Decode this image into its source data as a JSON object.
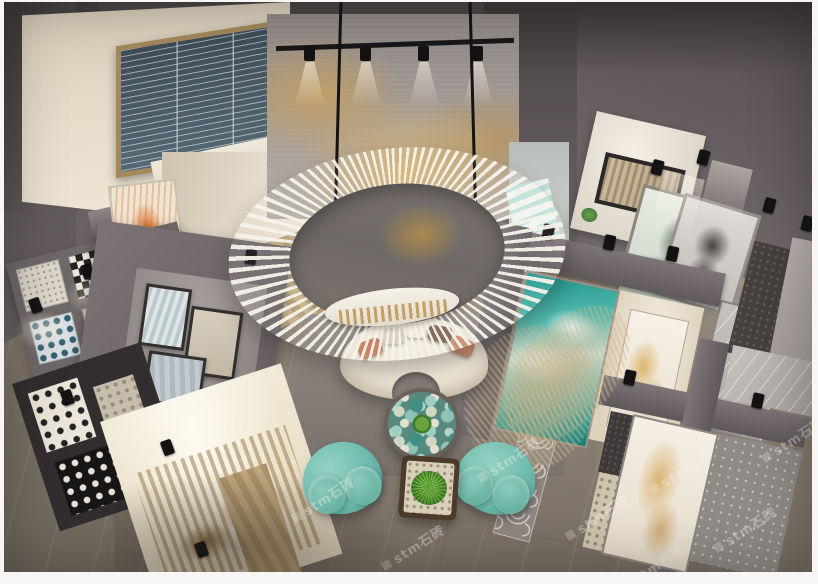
{
  "meta": {
    "title": "Tile and stone showroom interior - aerial 3D render",
    "description": "Bird's-eye view of a two-storey tile showroom: central white ring swing sculpture hanging over a curved cream sofa, pebble-top coffee table, two teal armchairs with a planted side table, gold-leaf feature mural wall, mezzanine window with blinds, and illuminated display partitions holding mosaic tiles, marble slabs, an ocean-wave slab and portrait tile murals."
  },
  "watermark": {
    "logo_glyph": "▦",
    "text": "stm石砖"
  },
  "palette": {
    "frame-white": "#f7f6f4",
    "wall-dark": "#494344",
    "wall-mid": "#6b6364",
    "wall-light": "#8a8180",
    "cream-wall": "#e2d7c4",
    "window-slate": "#47555f",
    "window-gold": "#a3885a",
    "mural-base": "#a29a95",
    "mural-gold": "#c6a05e",
    "floor-light": "#988c7f",
    "floor-dark": "#6f675e",
    "platform": "#837c76",
    "beam-gray": "#6e6769",
    "ring-white": "#f4f0e7",
    "sofa-cream": "#eee6d6",
    "pillow-salmon": "#c47b5e",
    "pillow-brown": "#7e6450",
    "chair-teal": "#6fbcae",
    "chair-teal-dark": "#4f9c8e",
    "wood-dark": "#4c3a2a",
    "plant-green": "#5d9c3c",
    "wave-teal": "#2fa39a",
    "backlit-cream": "#f0e9db",
    "sepia-brown": "#9b7743",
    "watermark-color": "rgba(244,242,236,0.38)"
  },
  "scene_areas": [
    "mezzanine-window",
    "gold-leaf-feature-wall",
    "ring-swing-sculpture",
    "lounge-seating",
    "left-mosaic-tile-grid",
    "gallery-partition",
    "sepia-mural-display",
    "polka-tile-display",
    "ocean-wave-slab-stand",
    "marble-slab-stand",
    "portrait-tile-murals",
    "marble-floor"
  ]
}
